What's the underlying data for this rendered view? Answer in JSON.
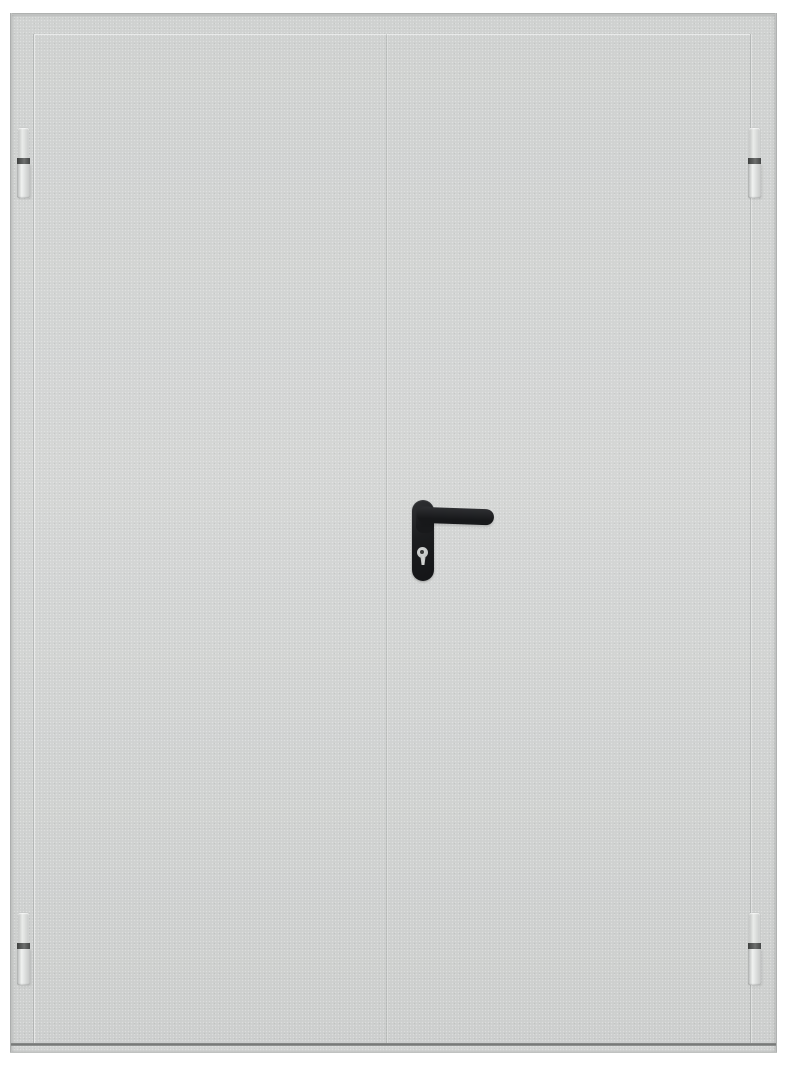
{
  "scene": {
    "type": "product-photo",
    "subject": "Double-leaf gray steel fire door, closed, front view on white background",
    "background_color": "#ffffff",
    "door": {
      "leaf_count": 2,
      "finish": "textured powder-coat speckle",
      "body_color": "#d3d5d4",
      "frame_edge_color": "#a7a9a8",
      "seam_color": "#c2c4c3",
      "bottom_edge_color": "#7b7d7c",
      "left_leaf_label": "left door leaf",
      "right_leaf_label": "right door leaf (active leaf with handle)",
      "frame_label": "door frame"
    },
    "hinges": {
      "count": 4,
      "positions": [
        "left-top",
        "left-bottom",
        "right-top",
        "right-bottom"
      ],
      "body_color": "#e3e5e4",
      "band_color": "#4a4c4b",
      "label": "barrel hinge"
    },
    "handle": {
      "type": "lever handle on rounded backplate with euro-cylinder keyhole",
      "color": "#1b1c1e",
      "keyhole_color": "#c9cbca",
      "lever_direction": "pointing right",
      "backplate_label": "handle backplate",
      "lever_label": "lever handle",
      "keyhole_label": "euro cylinder keyhole"
    }
  }
}
